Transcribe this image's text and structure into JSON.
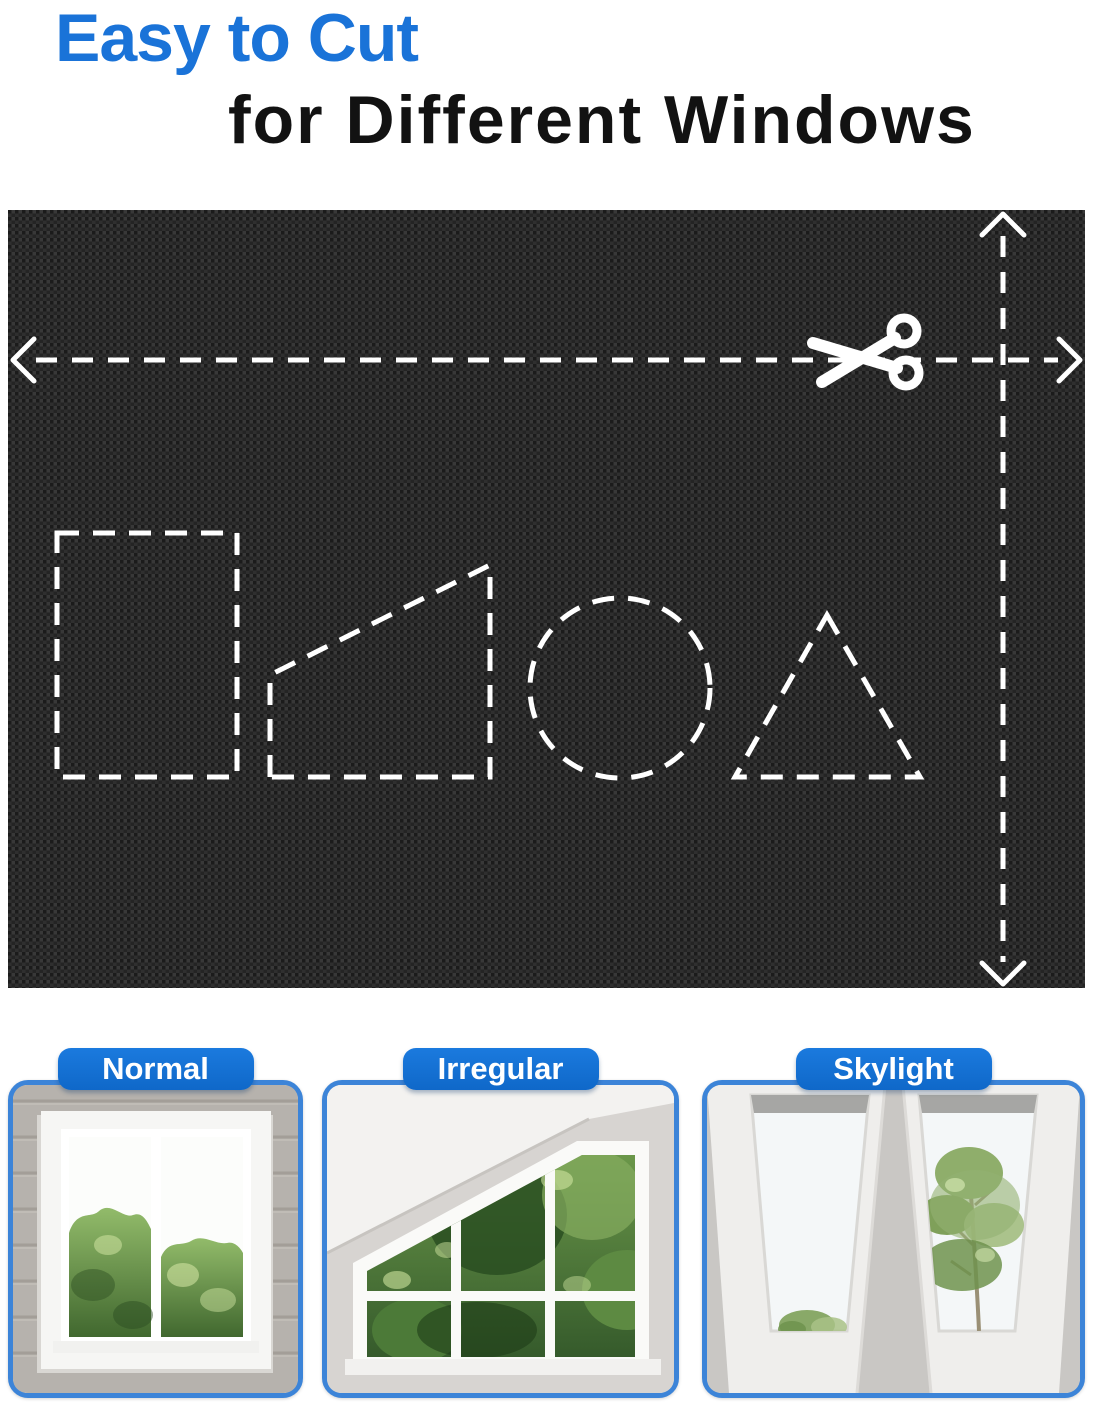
{
  "header": {
    "title_line1": "Easy to Cut",
    "title_line2": "for Different Windows",
    "title_accent_color": "#1a73d8"
  },
  "fabric_panel": {
    "icons": {
      "scissors": "scissors-icon",
      "horizontal_cut_line": "dashed-arrow-horizontal",
      "vertical_cut_line": "dashed-arrow-vertical"
    },
    "cut_shape_templates": [
      "rectangle",
      "trapezoid",
      "circle",
      "triangle"
    ]
  },
  "window_examples": [
    {
      "label": "Normal"
    },
    {
      "label": "Irregular"
    },
    {
      "label": "Skylight"
    }
  ],
  "colors": {
    "accent_blue": "#1a73d8",
    "badge_blue": "#1171d3",
    "card_border_blue": "#3c84d8",
    "fabric_black": "#222222",
    "dash_white": "#ffffff"
  }
}
